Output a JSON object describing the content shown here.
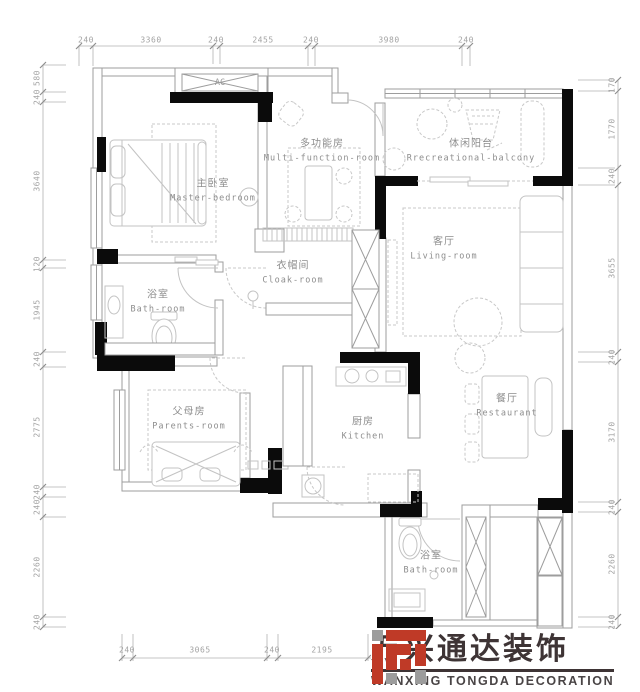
{
  "dims": {
    "top": [
      "240",
      "3360",
      "240",
      "2455",
      "240",
      "3980",
      "240"
    ],
    "left": [
      "580",
      "240",
      "3640",
      "120",
      "1945",
      "240",
      "2775",
      "240",
      "240",
      "2260",
      "240"
    ],
    "right": [
      "170",
      "1770",
      "240",
      "3655",
      "240",
      "3170",
      "240",
      "2260",
      "240"
    ],
    "bottom": [
      "240",
      "3065",
      "240",
      "2195"
    ]
  },
  "rooms": [
    {
      "id": "master-bedroom",
      "zh": "主卧室",
      "en": "Master-bedroom"
    },
    {
      "id": "multi-function-room",
      "zh": "多功能房",
      "en": "Multi-function-room"
    },
    {
      "id": "recreational-balcony",
      "zh": "体闲阳台",
      "en": "Rrecreational-balcony"
    },
    {
      "id": "living-room",
      "zh": "客厅",
      "en": "Living-room"
    },
    {
      "id": "bath-room-1",
      "zh": "浴室",
      "en": "Bath-room"
    },
    {
      "id": "cloak-room",
      "zh": "衣帽间",
      "en": "Cloak-room"
    },
    {
      "id": "parents-room",
      "zh": "父母房",
      "en": "Parents-room"
    },
    {
      "id": "kitchen",
      "zh": "厨房",
      "en": "Kitchen"
    },
    {
      "id": "restaurant",
      "zh": "餐厅",
      "en": "Restaurant"
    },
    {
      "id": "bath-room-2",
      "zh": "浴室",
      "en": "Bath-room"
    }
  ],
  "labels": {
    "ac": "AC"
  },
  "logo": {
    "zh": "万兴通达装饰",
    "en": "WANXING TONGDA DECORATION"
  },
  "colors": {
    "wall_black": "#0b0b0b",
    "wall_gray": "#9d9d9d",
    "furniture_gray": "#c3c3c3",
    "text_gray": "#8d8d8d",
    "dim_gray": "#a3a3a3",
    "logo_red": "#bf3a27",
    "logo_gray": "#9c9c9c",
    "logo_dark": "#3e3435"
  }
}
